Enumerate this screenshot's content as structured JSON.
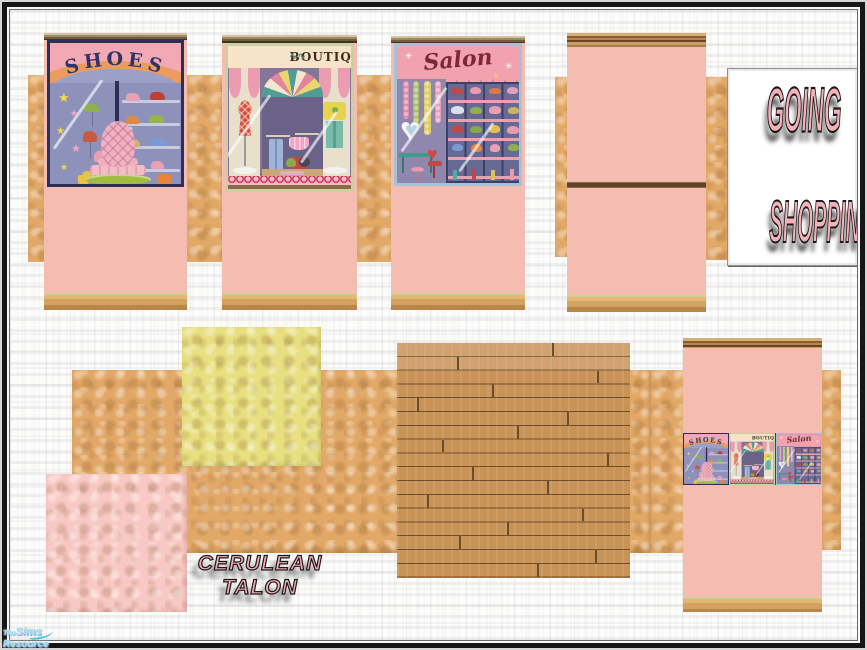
{
  "artwork": {
    "title_card": {
      "line1": "GOING",
      "line2": "SHOPPING!"
    },
    "creator_signature": {
      "line1": "CERULEAN",
      "line2": "TALON"
    },
    "watermark": {
      "prefix": "The",
      "name": "Sims",
      "suffix": "Resource"
    }
  },
  "murals": {
    "shoes": {
      "title": "SHOES",
      "star": "★"
    },
    "boutique": {
      "title": "BOUTIQUE",
      "flourish": "∿∿"
    },
    "salon": {
      "title": "Salon",
      "sparkle": "✳",
      "heart": "♥"
    }
  },
  "colors": {
    "wall_pink": "#f5bcb1",
    "stucco_tan": "#e1a867",
    "stucco_yellow": "#e7df80",
    "stucco_pink": "#f8c9c4",
    "floor_wood": "#c68f55",
    "trim_wood": "#c49b63",
    "title_pink": "#f4b2b8",
    "text_outline": "#1a1a1a",
    "frame_black": "#161616",
    "watermark_blue": "#9bd6f0"
  }
}
